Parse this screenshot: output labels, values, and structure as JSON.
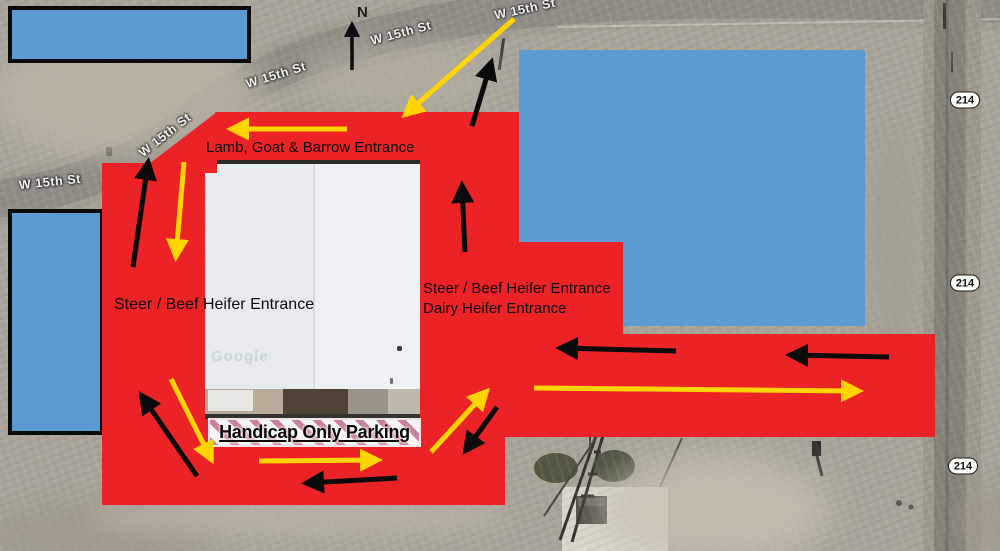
{
  "colors": {
    "route_red": "#ec2326",
    "building_blue": "#5c9ad2",
    "arrow_yellow": "#ffd400",
    "arrow_black": "#0a0a0a",
    "banner_pink": "#c9809e"
  },
  "map": {
    "north_indicator": {
      "label": "N"
    },
    "watermark": "Google",
    "street_labels": [
      {
        "text": "W 15th St",
        "x": 50,
        "y": 182,
        "rot": -6
      },
      {
        "text": "W 15th St",
        "x": 165,
        "y": 135,
        "rot": -38
      },
      {
        "text": "W 15th St",
        "x": 276,
        "y": 75,
        "rot": -17
      },
      {
        "text": "W 15th St",
        "x": 401,
        "y": 33,
        "rot": -15
      },
      {
        "text": "W 15th St",
        "x": 525,
        "y": 9,
        "rot": -12
      }
    ],
    "highway_badges": [
      {
        "text": "214",
        "x": 965,
        "y": 100
      },
      {
        "text": "214",
        "x": 965,
        "y": 283
      },
      {
        "text": "214",
        "x": 963,
        "y": 466
      }
    ]
  },
  "labels": {
    "lamb_entrance": "Lamb, Goat & Barrow Entrance",
    "steer_left_entrance": "Steer / Beef Heifer Entrance",
    "steer_right_entrance": "Steer / Beef Heifer Entrance",
    "dairy_entrance": "Dairy Heifer Entrance",
    "handicap_parking": "Handicap Only Parking"
  },
  "arrows": [
    {
      "color": "yellow",
      "x1": 347,
      "y1": 129,
      "x2": 232,
      "y2": 129,
      "name": "lamb-exit-arrow"
    },
    {
      "color": "yellow",
      "x1": 514,
      "y1": 19,
      "x2": 406,
      "y2": 114,
      "name": "lamb-entry-arrow"
    },
    {
      "color": "yellow",
      "x1": 184,
      "y1": 162,
      "x2": 176,
      "y2": 256,
      "name": "west-entry-arrow"
    },
    {
      "color": "yellow",
      "x1": 171,
      "y1": 379,
      "x2": 211,
      "y2": 459,
      "name": "southwest-entry-arrow"
    },
    {
      "color": "yellow",
      "x1": 259,
      "y1": 461,
      "x2": 377,
      "y2": 460,
      "name": "south-entry-arrow"
    },
    {
      "color": "yellow",
      "x1": 431,
      "y1": 452,
      "x2": 486,
      "y2": 392,
      "name": "center-entry-arrow"
    },
    {
      "color": "yellow",
      "x1": 534,
      "y1": 388,
      "x2": 858,
      "y2": 391,
      "name": "east-entry-arrow"
    },
    {
      "color": "black",
      "x1": 133,
      "y1": 267,
      "x2": 148,
      "y2": 163,
      "name": "west-exit-arrow"
    },
    {
      "color": "black",
      "x1": 472,
      "y1": 126,
      "x2": 491,
      "y2": 63,
      "name": "north-exit-arrow"
    },
    {
      "color": "black",
      "x1": 465,
      "y1": 252,
      "x2": 462,
      "y2": 186,
      "name": "strip-exit-arrow"
    },
    {
      "color": "black",
      "x1": 197,
      "y1": 476,
      "x2": 142,
      "y2": 396,
      "name": "southwest-exit-arrow"
    },
    {
      "color": "black",
      "x1": 397,
      "y1": 478,
      "x2": 307,
      "y2": 483,
      "name": "south-exit-arrow"
    },
    {
      "color": "black",
      "x1": 497,
      "y1": 407,
      "x2": 466,
      "y2": 450,
      "name": "center-exit-arrow"
    },
    {
      "color": "black",
      "x1": 676,
      "y1": 351,
      "x2": 561,
      "y2": 348,
      "name": "east-exit-arrow-1"
    },
    {
      "color": "black",
      "x1": 889,
      "y1": 357,
      "x2": 791,
      "y2": 355,
      "name": "east-exit-arrow-2"
    },
    {
      "color": "black",
      "x1": 352,
      "y1": 70,
      "x2": 352,
      "y2": 25,
      "w": 3.5,
      "name": "north-compass-arrow"
    }
  ]
}
